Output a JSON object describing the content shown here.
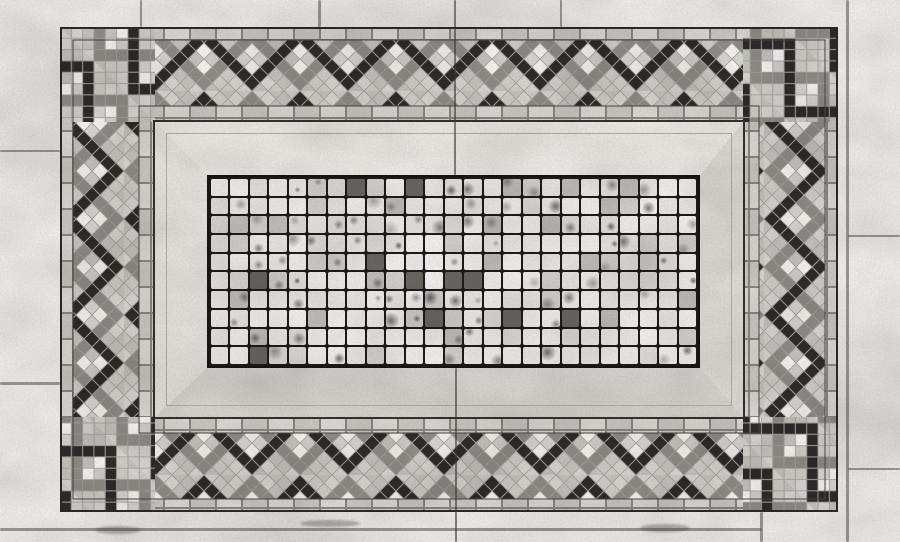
{
  "photo": {
    "subject": "grayscale photograph of a marble mosaic floor panel",
    "elements": [
      "outer marble slab surround",
      "interlocking double-zigzag tessera border band",
      "small brick tile courses",
      "beveled marble frame with mitered corners",
      "central grid of square marble tesserae"
    ]
  },
  "palette": {
    "slab": "#f3f2f0",
    "line_dark": "#2b2a28",
    "band_bg": "#cfccc8",
    "band_light": [
      "#dcdad6",
      "#c9c6c2",
      "#d4d1cd"
    ],
    "chain_dark": "#2e2c2a",
    "chain_gray": "#918e8a",
    "band_white": "#f8f7f5",
    "band_stroke": "#a8a5a1",
    "brick": [
      "#dedcd8",
      "#cccac6",
      "#d7d4d0",
      "#c5c2be"
    ],
    "brick_grout": "#8b8884",
    "frame_top": "#efede9",
    "frame_right": "#e1dfda",
    "frame_bottom": "#d9d7d2",
    "frame_left": "#e7e5e0",
    "grid_grout": "#1c1b1a",
    "tile_shades": [
      "#f5f4f2",
      "#efeeec",
      "#e9e8e5",
      "#e1dfdc",
      "#d5d3cf",
      "#c2c0bc"
    ],
    "dark_tile": "#6b6864"
  },
  "border_band": {
    "period": 96,
    "band_height": 64,
    "diamond_half": 8,
    "dark_chain": [
      [
        0,
        56
      ],
      [
        8,
        48
      ],
      [
        16,
        40
      ],
      [
        24,
        32
      ],
      [
        32,
        24
      ],
      [
        40,
        16
      ],
      [
        48,
        8
      ],
      [
        56,
        16
      ],
      [
        64,
        24
      ],
      [
        72,
        32
      ],
      [
        80,
        40
      ],
      [
        88,
        48
      ],
      [
        96,
        56
      ]
    ],
    "gray_chain": [
      [
        48,
        56
      ],
      [
        56,
        48
      ],
      [
        64,
        40
      ],
      [
        72,
        32
      ],
      [
        80,
        24
      ],
      [
        88,
        16
      ],
      [
        96,
        8
      ],
      [
        0,
        8
      ],
      [
        8,
        16
      ],
      [
        16,
        24
      ],
      [
        24,
        32
      ],
      [
        32,
        40
      ],
      [
        40,
        48
      ]
    ],
    "white_cells": [
      [
        0,
        24
      ],
      [
        48,
        24
      ],
      [
        96,
        24
      ],
      [
        0,
        40
      ],
      [
        48,
        40
      ],
      [
        96,
        40
      ]
    ],
    "light_cells": [
      [
        8,
        0
      ],
      [
        24,
        0
      ],
      [
        40,
        0
      ],
      [
        56,
        0
      ],
      [
        72,
        0
      ],
      [
        88,
        0
      ],
      [
        16,
        8
      ],
      [
        32,
        8
      ],
      [
        64,
        8
      ],
      [
        80,
        8
      ],
      [
        24,
        16
      ],
      [
        72,
        16
      ],
      [
        8,
        32
      ],
      [
        40,
        32
      ],
      [
        56,
        32
      ],
      [
        88,
        32
      ],
      [
        24,
        48
      ],
      [
        72,
        48
      ],
      [
        16,
        56
      ],
      [
        32,
        56
      ],
      [
        64,
        56
      ],
      [
        80,
        56
      ],
      [
        8,
        64
      ],
      [
        24,
        64
      ],
      [
        40,
        64
      ],
      [
        56,
        64
      ],
      [
        72,
        64
      ],
      [
        88,
        64
      ]
    ]
  },
  "brick_course": {
    "tile_w": 26,
    "tile_h": 13
  },
  "ring": {
    "x": 60,
    "y": 27,
    "w": 778,
    "h": 485,
    "thickness": 95,
    "brick_outer": 13,
    "zig": 66,
    "brick_inner": 16
  },
  "frame": {
    "x": 155,
    "y": 122,
    "w": 588,
    "h": 295,
    "border_top": 53,
    "border_right": 43,
    "border_bottom": 49,
    "border_left": 52,
    "step_inset": 11
  },
  "tile_grid": {
    "x": 207,
    "y": 175,
    "w": 493,
    "h": 193,
    "columns": 25,
    "rows": 10,
    "gap": 2,
    "seed": 42,
    "shade_weights": [
      0.28,
      0.22,
      0.18,
      0.13,
      0.11,
      0.08
    ],
    "speckle_chance": 0.34,
    "dark_tile_chance": 0.05
  },
  "marks": [
    {
      "kind": "joint",
      "x": 318,
      "y": 0,
      "w": 3,
      "h": 27
    },
    {
      "kind": "joint",
      "x": 560,
      "y": 0,
      "w": 2,
      "h": 27
    },
    {
      "kind": "joint",
      "x": 140,
      "y": 0,
      "w": 2,
      "h": 27
    },
    {
      "kind": "joint",
      "x": 846,
      "y": 0,
      "w": 3,
      "h": 542
    },
    {
      "kind": "joint",
      "x": 848,
      "y": 235,
      "w": 52,
      "h": 2
    },
    {
      "kind": "joint",
      "x": 848,
      "y": 468,
      "w": 52,
      "h": 2
    },
    {
      "kind": "joint",
      "x": 0,
      "y": 150,
      "w": 60,
      "h": 2
    },
    {
      "kind": "joint",
      "x": 0,
      "y": 382,
      "w": 60,
      "h": 3
    },
    {
      "kind": "joint",
      "x": 0,
      "y": 528,
      "w": 762,
      "h": 3
    },
    {
      "kind": "joint",
      "x": 760,
      "y": 512,
      "w": 3,
      "h": 30
    },
    {
      "kind": "crack",
      "x": 454,
      "y": 0,
      "w": 2,
      "h": 175
    },
    {
      "kind": "crack",
      "x": 455,
      "y": 368,
      "w": 2,
      "h": 174
    },
    {
      "kind": "stain",
      "x": 95,
      "y": 526,
      "w": 46,
      "h": 8
    },
    {
      "kind": "stain",
      "x": 300,
      "y": 520,
      "w": 60,
      "h": 7
    },
    {
      "kind": "stain",
      "x": 640,
      "y": 524,
      "w": 50,
      "h": 8
    }
  ]
}
